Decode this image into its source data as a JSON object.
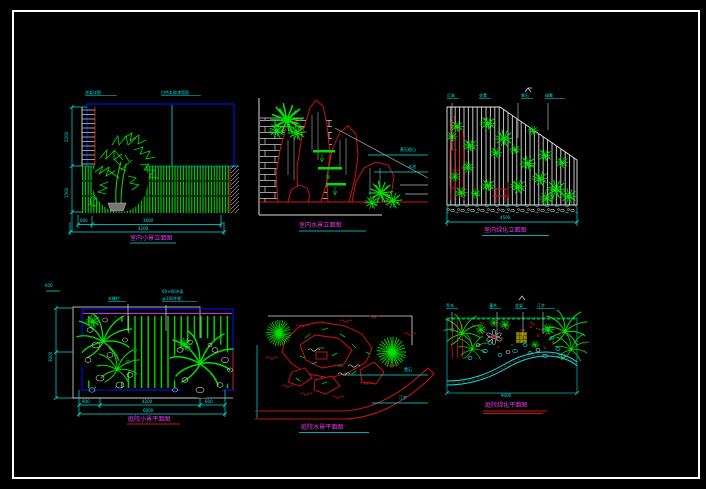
{
  "sheet": {
    "background": "#000000",
    "frame_color": "#ffffff",
    "colors": {
      "vegetation": "#00e000",
      "rock_red": "#e01212",
      "dimension_cyan": "#00e5e5",
      "outline_blue": "#0010dd",
      "caption_magenta": "#e838e8",
      "wall_white": "#d8d8d8"
    }
  },
  "panels": [
    {
      "caption": "室内小景立面图",
      "top_labels": [
        "花架详图",
        "白色乳胶漆墙面"
      ],
      "dims": {
        "d1": "600",
        "d2": "3600",
        "total": "4200",
        "h1": "2200",
        "h2": "1500"
      }
    },
    {
      "caption": "室内水景立面图",
      "leaders": [
        "黄石假山",
        "水池"
      ]
    },
    {
      "caption": "室内绿化立面图",
      "top_labels": [
        "灯具",
        "坐凳",
        "景石",
        "绿篱"
      ],
      "dims": {
        "total": "4500"
      }
    },
    {
      "caption": "庭院小景平面图",
      "corner_label": "600",
      "leaders": [
        "木栅栏",
        "60×60木条",
        "@100中距"
      ],
      "dims": {
        "d1": "900",
        "d2": "4200",
        "d3": "600",
        "total": "6000",
        "left": "3000"
      }
    },
    {
      "caption": "庭院水景平面图",
      "leaders": [
        "置石",
        "汀步"
      ]
    },
    {
      "caption": "庭院绿化平面图",
      "top_labels": [
        "乔木",
        "灌木",
        "花架",
        "汀步"
      ],
      "dims": {
        "total": "9000"
      }
    }
  ]
}
